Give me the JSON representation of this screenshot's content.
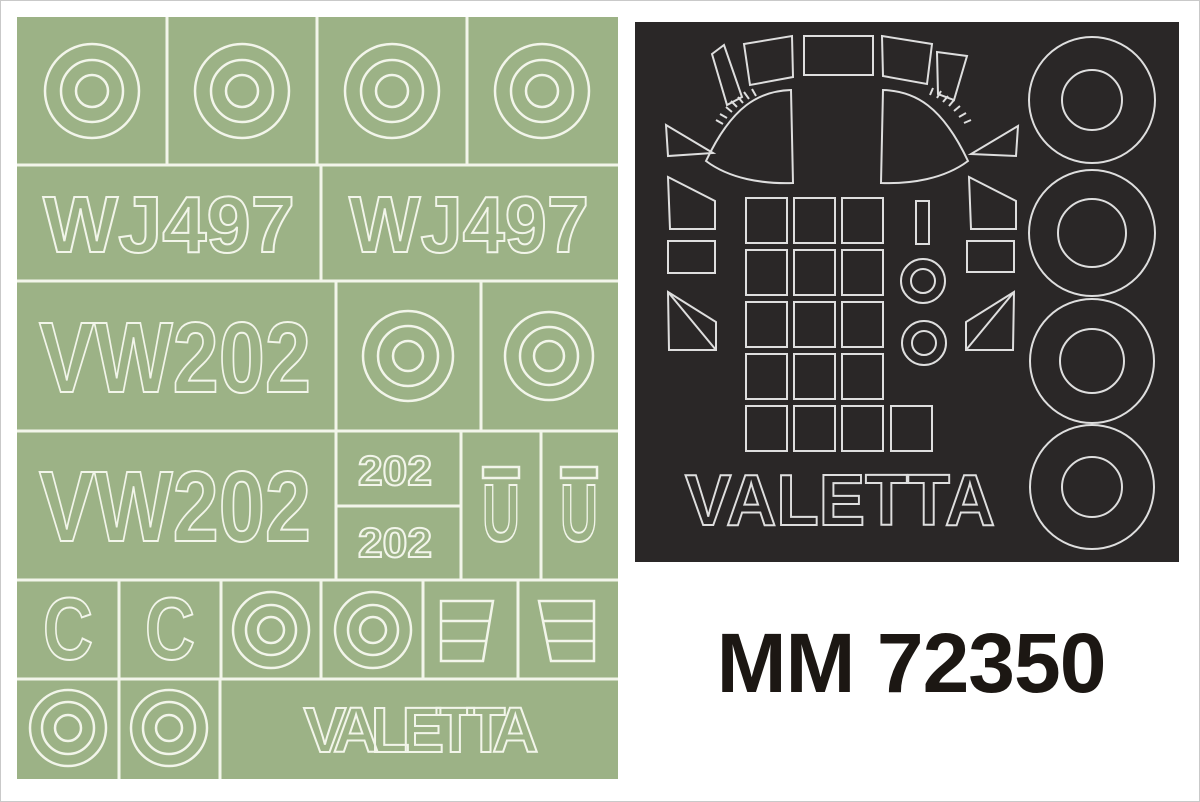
{
  "product": {
    "code": "MM 72350"
  },
  "green_sheet": {
    "kind": "insignia and code letters paint mask sheet",
    "bg_color": "#9cb286",
    "line_color": "#f2f5ea",
    "serial_top_left": "WJ497",
    "serial_top_right": "WJ497",
    "serial_mid": "VW202",
    "serial_low": "VW202",
    "number_small_top": "202",
    "number_small_bottom": "202",
    "letter_u_left": "U",
    "letter_u_right": "U",
    "letter_c_left": "C",
    "letter_c_right": "C",
    "title": "VALETTA"
  },
  "black_sheet": {
    "kind": "canopy and wheel mask sheet",
    "bg_color": "#2a2727",
    "line_color": "#dedede",
    "title": "VALETTA"
  }
}
